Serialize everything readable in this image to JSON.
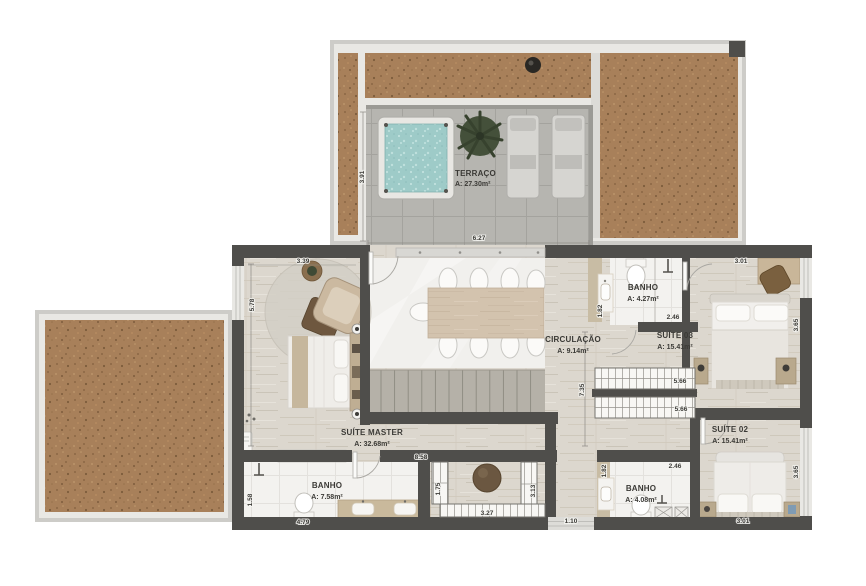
{
  "plan_title": "floor-plan",
  "rooms": {
    "terraco": {
      "name": "TERRAÇO",
      "area": "A: 27.30m²"
    },
    "suite_master": {
      "name": "SUÍTE MASTER",
      "area": "A: 32.68m²"
    },
    "circulacao": {
      "name": "CIRCULAÇÃO",
      "area": "A: 9.14m²"
    },
    "banho_superior": {
      "name": "BANHO",
      "area": "A: 4.27m²"
    },
    "suite_03": {
      "name": "SUÍTE 03",
      "area": "A: 15.41m²"
    },
    "suite_02": {
      "name": "SUÍTE 02",
      "area": "A: 15.41m²"
    },
    "banho_inferior": {
      "name": "BANHO",
      "area": "A: 7.58m²"
    },
    "banho_suite02": {
      "name": "BANHO",
      "area": "A: 4.08m²"
    }
  },
  "dimensions": {
    "terrace_depth": "3.91",
    "terrace_width": "6.27",
    "master_width": "3.39",
    "master_depth": "5.78",
    "master_bottom": "8.58",
    "banho_sup_depth": "1.82",
    "banho_sup_width": "2.46",
    "suite03_width": "3.01",
    "suite03_depth": "3.65",
    "closet_sup": "5.66",
    "closet_inf": "5.66",
    "circ_depth": "7.35",
    "closet_left": "1.75",
    "closet_width": "3.27",
    "closet_right": "3.13",
    "banho_inf_left": "1.58",
    "banho_inf_width": "4.79",
    "hall_width": "1.10",
    "banho_s02_depth": "1.82",
    "banho_s02_width": "2.46",
    "suite02_depth": "3.65",
    "suite02_width": "3.01"
  },
  "colors": {
    "wall_dark": "#4f4e4b",
    "wall_light": "#cdccc8",
    "cork": "#a8805a",
    "floor_wood": "#dcd7ce",
    "terrace_tile": "#b6b5b0",
    "bath_tile": "#f3f2ef",
    "water": "#9ecbc8",
    "label_text": "#3b3a36"
  }
}
